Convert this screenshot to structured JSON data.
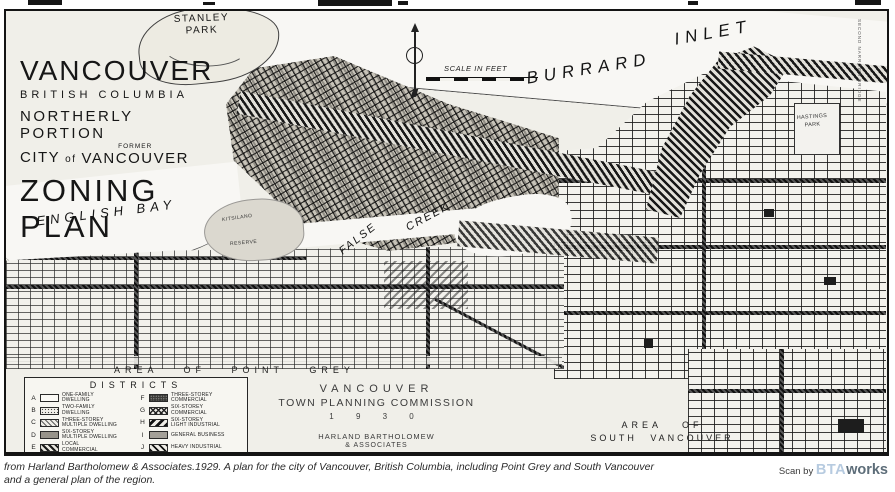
{
  "map": {
    "title": {
      "line1": "VANCOUVER",
      "line2": "BRITISH COLUMBIA",
      "line3": "NORTHERLY PORTION",
      "city": "CITY",
      "of": "of",
      "former": "FORMER",
      "vancouver2": "VANCOUVER",
      "line5": "ZONING PLAN"
    },
    "labels": {
      "stanley1": "STANLEY",
      "stanley2": "PARK",
      "burrard": "BURRARD",
      "inlet": "INLET",
      "english_bay": "ENGLISH  BAY",
      "false_word": "FALSE",
      "creek_word": "CREEK",
      "kitsilano": "KITSILANO",
      "reserve": "RESERVE",
      "hastings1": "HASTINGS",
      "hastings2": "PARK",
      "area_point_grey": "AREA OF POINT GREY",
      "area_south1": "AREA OF",
      "area_south2": "SOUTH VANCOUVER",
      "second_narrows": "SECOND NARROWS BRIDGE",
      "scale_label": "SCALE IN FEET"
    },
    "legend": {
      "title": "DISTRICTS",
      "items": [
        {
          "key": "A",
          "l1": "ONE-FAMILY",
          "l2": "DWELLING",
          "pattern": "plain"
        },
        {
          "key": "B",
          "l1": "TWO-FAMILY",
          "l2": "DWELLING",
          "pattern": "dots-light"
        },
        {
          "key": "C",
          "l1": "THREE-STOREY",
          "l2": "MULTIPLE DWELLING",
          "pattern": "hatch-light"
        },
        {
          "key": "D",
          "l1": "SIX-STOREY",
          "l2": "MULTIPLE DWELLING",
          "pattern": "gray-medium"
        },
        {
          "key": "E",
          "l1": "LOCAL",
          "l2": "COMMERCIAL",
          "pattern": "hatch-dark"
        },
        {
          "key": "F",
          "l1": "THREE-STOREY",
          "l2": "COMMERCIAL",
          "pattern": "dense-dark"
        },
        {
          "key": "G",
          "l1": "SIX-STOREY",
          "l2": "COMMERCIAL",
          "pattern": "crosshatch"
        },
        {
          "key": "H",
          "l1": "SIX-STOREY",
          "l2": "LIGHT INDUSTRIAL",
          "pattern": "stripes-back"
        },
        {
          "key": "I",
          "l1": "GENERAL BUSINESS",
          "l2": "",
          "pattern": "gray-solid"
        },
        {
          "key": "J",
          "l1": "HEAVY INDUSTRIAL",
          "l2": "",
          "pattern": "stripes-forward"
        }
      ]
    },
    "commission": {
      "line1": "VANCOUVER",
      "line2": "TOWN PLANNING COMMISSION",
      "line3": "1 9 3 0",
      "line4": "HARLAND BARTHOLOMEW",
      "line5": "& ASSOCIATES",
      "line6": "TOWN PLANNING CONSULTANTS"
    }
  },
  "caption": {
    "line1": "from Harland Bartholomew & Associates.1929. A plan for the city of Vancouver, British Columbia, including Point Grey and South Vancouver",
    "line2": "and a general plan of the region."
  },
  "credit": {
    "prefix": "Scan by ",
    "brand_light": "BTA",
    "brand_dark": "works"
  },
  "colors": {
    "bta_light": "#b7cbe0",
    "bta_dark": "#5d6d79",
    "paper": "#f0efe9",
    "ink": "#141414"
  }
}
